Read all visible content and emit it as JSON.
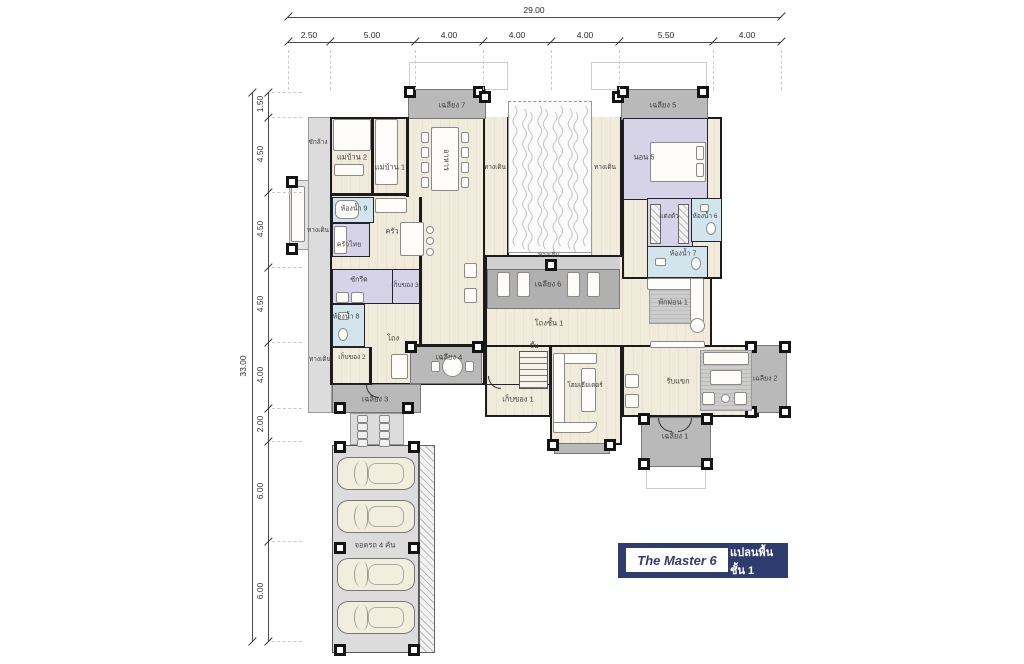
{
  "title_block": {
    "name": "The Master 6",
    "plan": "แปลนพื้นชั้น 1"
  },
  "dimensions": {
    "top_total": "29.00",
    "top_segments": [
      "2.50",
      "5.00",
      "4.00",
      "4.00",
      "4.00",
      "5.50",
      "4.00"
    ],
    "left_total": "33.00",
    "left_segments": [
      "1.50",
      "4.50",
      "4.50",
      "4.50",
      "4.00",
      "2.00",
      "6.00",
      "6.00"
    ]
  },
  "rooms": {
    "porch7": "เฉลียง 7",
    "porch5": "เฉลียง 5",
    "porch6": "เฉลียง 6",
    "porch4": "เฉลียง 4",
    "porch3": "เฉลียง 3",
    "porch2": "เฉลียง 2",
    "porch1": "เฉลียง 1",
    "maid2": "แม่บ้าน 2",
    "maid1": "แม่บ้าน 1",
    "dining": "อาหาร",
    "laundry_yard": "ซักล้าง",
    "walkway": "ทางเดิน",
    "bath9": "ห้องน้ำ 9",
    "bath8": "ห้องน้ำ 8",
    "bath7": "ห้องน้ำ 7",
    "bath6": "ห้องน้ำ 6",
    "pantry": "ครัว",
    "thai_kitchen": "ครัวไทย",
    "ironing": "ซักรีด",
    "storage3": "เก็บของ 3",
    "storage2": "เก็บของ 2",
    "storage1": "เก็บของ 1",
    "bed5": "นอน 5",
    "dressing": "แต่งตัว",
    "relax1": "พักผ่อน 1",
    "hall1": "โถงชั้น 1",
    "hall": "โถง",
    "up": "ขึ้น",
    "home_theater": "โฮมเธียเตอร์",
    "living": "รับแขก",
    "parking": "จอดรถ 4 คัน"
  },
  "colors": {
    "navy": "#2e3c6e",
    "bedroom_fill": "#d6d3e8",
    "bathroom_fill": "#d2e5ec",
    "porch_fill": "#b9b9b9",
    "floor_fill": "#f1ebdc",
    "wall": "#1b1b1b"
  }
}
